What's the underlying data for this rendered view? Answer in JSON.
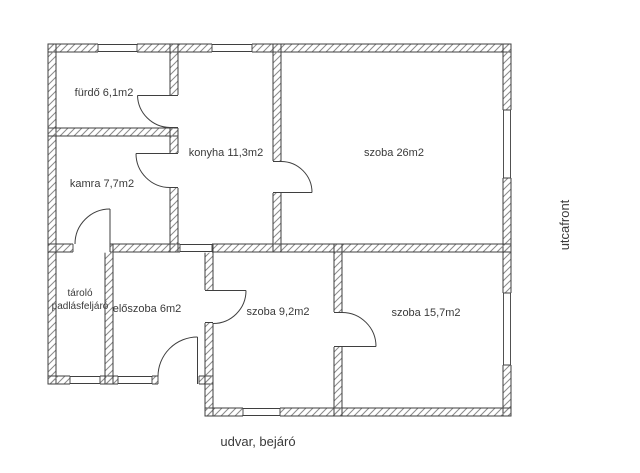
{
  "rooms": [
    {
      "id": "furdo",
      "label": "fürdő 6,1m2"
    },
    {
      "id": "kamra",
      "label": "kamra 7,7m2"
    },
    {
      "id": "konyha",
      "label": "konyha 11,3m2"
    },
    {
      "id": "szoba26",
      "label": "szoba 26m2"
    },
    {
      "id": "tarolo",
      "label": "tároló",
      "label2": "padlásfeljáró"
    },
    {
      "id": "eloszoba",
      "label": "előszoba 6m2"
    },
    {
      "id": "szoba92",
      "label": "szoba 9,2m2"
    },
    {
      "id": "szoba157",
      "label": "szoba 15,7m2"
    }
  ],
  "annotations": {
    "street_front": "utcafront",
    "yard_entrance": "udvar, bejáró"
  },
  "colors": {
    "line": "#3f3f3f",
    "hatch": "#8a8a8a",
    "text": "#3a3a3a",
    "bg": "#ffffff"
  }
}
